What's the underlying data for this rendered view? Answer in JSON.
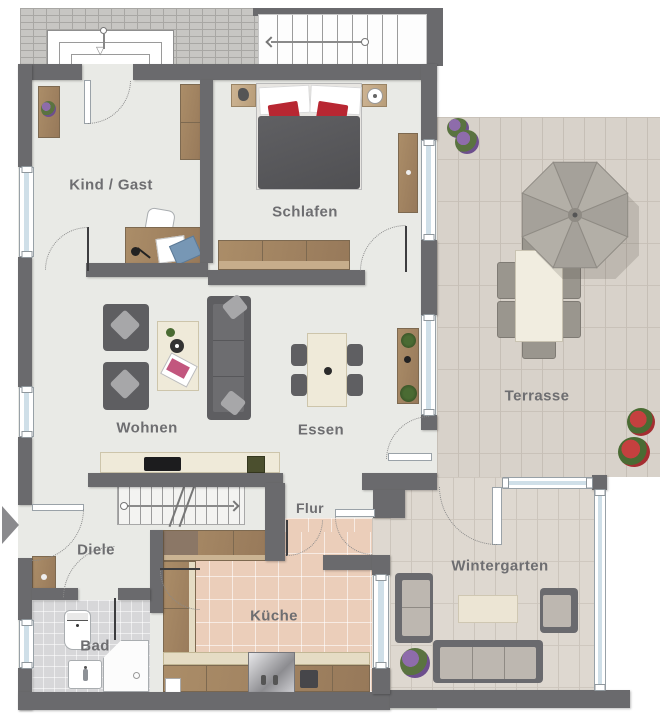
{
  "rooms": {
    "kind_gast": {
      "label": "Kind / Gast"
    },
    "schlafen": {
      "label": "Schlafen"
    },
    "wohnen": {
      "label": "Wohnen"
    },
    "essen": {
      "label": "Essen"
    },
    "terrasse": {
      "label": "Terrasse"
    },
    "flur": {
      "label": "Flur"
    },
    "diele": {
      "label": "Diele"
    },
    "kueche": {
      "label": "Küche"
    },
    "bad": {
      "label": "Bad"
    },
    "wintergarten": {
      "label": "Wintergarten"
    }
  },
  "colors": {
    "wall": "#6a6a6d",
    "floor": "#e9eae6",
    "terrace": "#d8d2ca",
    "wintergarten_floor": "#ded8d0",
    "kitchen_floor": "#ebceba",
    "bath_floor": "#d7d7d9",
    "glass": "#cfdfe8",
    "sofa_dark": "#5e5e61",
    "bed_red": "#b82732",
    "label_text": "#6e6e71"
  }
}
